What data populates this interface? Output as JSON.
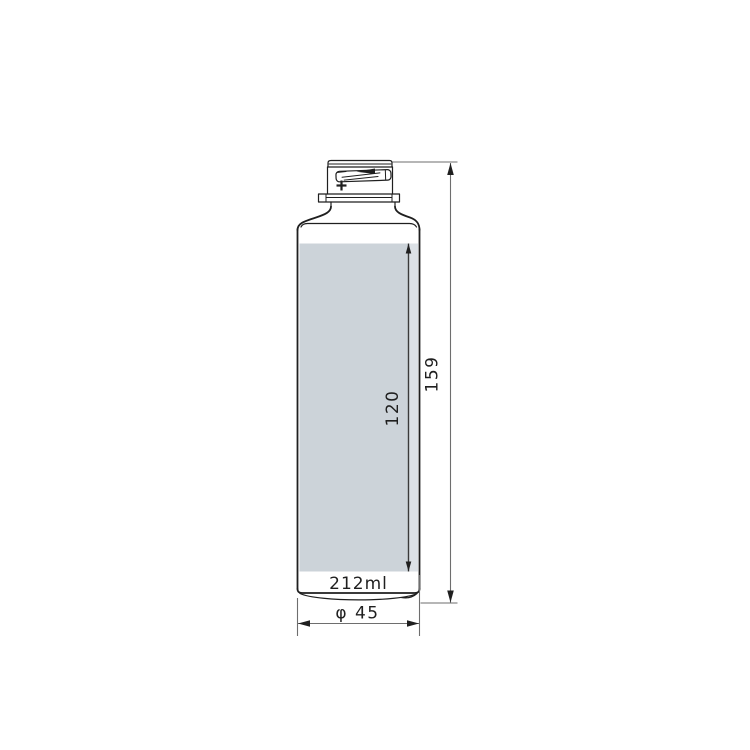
{
  "drawing": {
    "volume_label": "212ml",
    "dimensions": {
      "total_height": "159",
      "label_height": "120",
      "diameter": "φ 45"
    },
    "colors": {
      "outline": "#1f1f1f",
      "dimension_line": "#6e6e6e",
      "text": "#1f1f1f",
      "label_fill": "#ccd3d9",
      "label_highlight": "#dce1e6",
      "background": "#ffffff"
    }
  }
}
